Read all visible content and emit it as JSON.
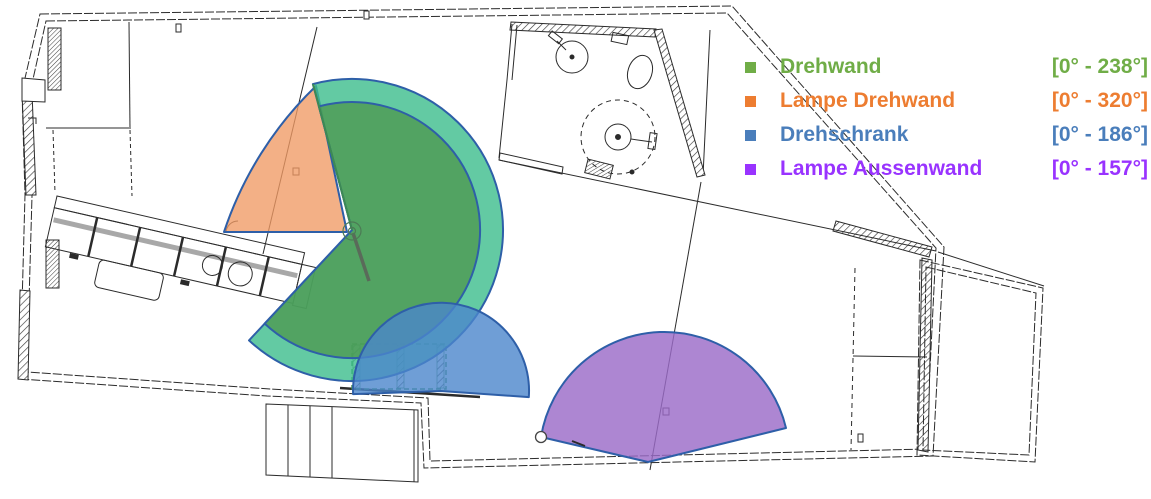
{
  "legend": {
    "items": [
      {
        "id": "drehwand",
        "label": "Drehwand",
        "range": "[0° - 238°]",
        "color": "#70AD47"
      },
      {
        "id": "lampe-drehwand",
        "label": "Lampe Drehwand",
        "range": "[0° - 320°]",
        "color": "#ED7D31"
      },
      {
        "id": "drehschrank",
        "label": "Drehschrank",
        "range": "[0° - 186°]",
        "color": "#4A7EBB"
      },
      {
        "id": "lampe-aussenwand",
        "label": "Lampe Aussenwand",
        "range": "[0° - 157°]",
        "color": "#9933FF"
      }
    ]
  },
  "sectors": {
    "stroke": "#2E5FA8",
    "items": [
      {
        "id": "lampe-drehwand",
        "name": "Lampe Drehwand",
        "range_deg": [
          0,
          320
        ],
        "color": "#F09A64",
        "opacity": 0.78,
        "path": "M347,232 L224,232 A360,360 0 0 1 316,86 Z"
      },
      {
        "id": "drehwand-outer",
        "name": "Drehwand (outer sweep)",
        "range_deg": [
          0,
          238
        ],
        "color": "#3CBD8C",
        "opacity": 0.8,
        "path": "M352,230 L312.9,84.1 A151,151 0 1 1 249,340.4 Z"
      },
      {
        "id": "drehwand-inner",
        "name": "Drehwand (inner sweep)",
        "range_deg": [
          0,
          238
        ],
        "color": "#4E9951",
        "opacity": 0.8,
        "path": "M352,230 L318.9,106.4 A128,128 0 1 1 264.7,323.6 Z"
      },
      {
        "id": "drehschrank",
        "name": "Drehschrank",
        "range_deg": [
          0,
          186
        ],
        "color": "#4B86CC",
        "opacity": 0.8,
        "path": "M441,391 L528.8,397.1 A88,88 0 1 0 353.1,394.1 Z"
      },
      {
        "id": "lampe-aussenwand",
        "name": "Lampe Aussenwand",
        "range_deg": [
          0,
          157
        ],
        "color": "#9B6BC8",
        "opacity": 0.82,
        "path": "M648,462 L541,437 A125,125 0 0 1 786,428 Z"
      }
    ]
  }
}
